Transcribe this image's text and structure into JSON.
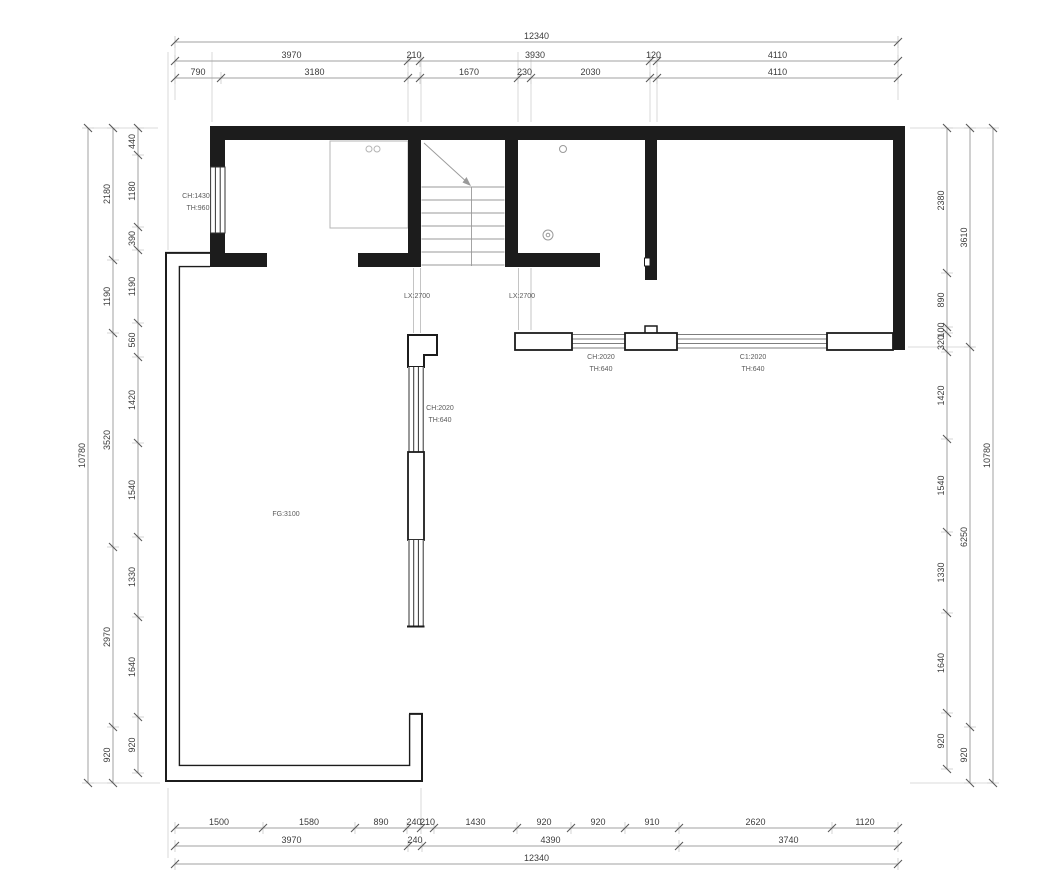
{
  "drawing": {
    "type": "floor-plan",
    "background": "#ffffff"
  },
  "colors": {
    "wall": "#1c1c1c",
    "dim_line": "#a2a2a2",
    "dim_text": "#3c3c3c",
    "tick": "#5a5a5a",
    "stub": "#c9c9c9",
    "stair": "#9a9a9a",
    "furniture": "#b5b5b5",
    "glazing": "#7d7d7d",
    "annotation": "#5a5a5a"
  },
  "dimensions": {
    "top_rows": [
      {
        "y": 42,
        "segments": [
          {
            "label": "12340",
            "a": 175,
            "b": 898
          }
        ]
      },
      {
        "y": 61,
        "segments": [
          {
            "label": "3970",
            "a": 175,
            "b": 408
          },
          {
            "label": "210",
            "a": 408,
            "b": 420
          },
          {
            "label": "3930",
            "a": 420,
            "b": 650
          },
          {
            "label": "120",
            "a": 650,
            "b": 657
          },
          {
            "label": "4110",
            "a": 657,
            "b": 898
          }
        ]
      },
      {
        "y": 78,
        "segments": [
          {
            "label": "790",
            "a": 175,
            "b": 221
          },
          {
            "label": "3180",
            "a": 221,
            "b": 408
          },
          {
            "label": "",
            "a": 408,
            "b": 420
          },
          {
            "label": "1670",
            "a": 420,
            "b": 518
          },
          {
            "label": "230",
            "a": 518,
            "b": 531
          },
          {
            "label": "2030",
            "a": 531,
            "b": 650
          },
          {
            "label": "",
            "a": 650,
            "b": 657
          },
          {
            "label": "4110",
            "a": 657,
            "b": 898
          }
        ]
      }
    ],
    "bottom_rows": [
      {
        "y": 828,
        "segments": [
          {
            "label": "1500",
            "a": 175,
            "b": 263
          },
          {
            "label": "1580",
            "a": 263,
            "b": 355
          },
          {
            "label": "890",
            "a": 355,
            "b": 407
          },
          {
            "label": "240",
            "a": 407,
            "b": 421
          },
          {
            "label": "210",
            "a": 421,
            "b": 434
          },
          {
            "label": "1430",
            "a": 434,
            "b": 517
          },
          {
            "label": "920",
            "a": 517,
            "b": 571
          },
          {
            "label": "920",
            "a": 571,
            "b": 625
          },
          {
            "label": "910",
            "a": 625,
            "b": 679
          },
          {
            "label": "2620",
            "a": 679,
            "b": 832
          },
          {
            "label": "1120",
            "a": 832,
            "b": 898
          }
        ]
      },
      {
        "y": 846,
        "segments": [
          {
            "label": "3970",
            "a": 175,
            "b": 408
          },
          {
            "label": "240",
            "a": 408,
            "b": 422
          },
          {
            "label": "4390",
            "a": 422,
            "b": 679
          },
          {
            "label": "3740",
            "a": 679,
            "b": 898
          }
        ]
      },
      {
        "y": 864,
        "segments": [
          {
            "label": "12340",
            "a": 175,
            "b": 898
          }
        ]
      }
    ],
    "left_cols": [
      {
        "x": 88,
        "segments": [
          {
            "label": "10780",
            "a": 128,
            "b": 783
          }
        ]
      },
      {
        "x": 113,
        "segments": [
          {
            "label": "2180",
            "a": 128,
            "b": 260
          },
          {
            "label": "1190",
            "a": 260,
            "b": 333
          },
          {
            "label": "3520",
            "a": 333,
            "b": 547
          },
          {
            "label": "2970",
            "a": 547,
            "b": 727
          },
          {
            "label": "920",
            "a": 727,
            "b": 783
          }
        ]
      },
      {
        "x": 138,
        "segments": [
          {
            "label": "440",
            "a": 128,
            "b": 155
          },
          {
            "label": "1180",
            "a": 155,
            "b": 227
          },
          {
            "label": "390",
            "a": 227,
            "b": 250
          },
          {
            "label": "1190",
            "a": 250,
            "b": 323
          },
          {
            "label": "560",
            "a": 323,
            "b": 357
          },
          {
            "label": "1420",
            "a": 357,
            "b": 443
          },
          {
            "label": "1540",
            "a": 443,
            "b": 537
          },
          {
            "label": "1330",
            "a": 537,
            "b": 617
          },
          {
            "label": "1640",
            "a": 617,
            "b": 717
          },
          {
            "label": "920",
            "a": 717,
            "b": 773
          }
        ]
      }
    ],
    "right_cols": [
      {
        "x": 947,
        "segments": [
          {
            "label": "2380",
            "a": 128,
            "b": 273
          },
          {
            "label": "890",
            "a": 273,
            "b": 327
          },
          {
            "label": "100",
            "a": 327,
            "b": 333
          },
          {
            "label": "320",
            "a": 333,
            "b": 352
          },
          {
            "label": "1420",
            "a": 352,
            "b": 439
          },
          {
            "label": "1540",
            "a": 439,
            "b": 532
          },
          {
            "label": "1330",
            "a": 532,
            "b": 613
          },
          {
            "label": "1640",
            "a": 613,
            "b": 713
          },
          {
            "label": "920",
            "a": 713,
            "b": 769
          }
        ]
      },
      {
        "x": 970,
        "segments": [
          {
            "label": "3610",
            "a": 128,
            "b": 347
          },
          {
            "label": "6250",
            "a": 347,
            "b": 727
          },
          {
            "label": "920",
            "a": 727,
            "b": 783
          }
        ]
      },
      {
        "x": 993,
        "segments": [
          {
            "label": "10780",
            "a": 128,
            "b": 783
          }
        ]
      }
    ]
  },
  "annotations": [
    {
      "id": "west-window-label-1",
      "text": "CH:1430",
      "x": 196,
      "y": 198
    },
    {
      "id": "west-window-label-2",
      "text": "TH:960",
      "x": 198,
      "y": 210
    },
    {
      "id": "passage-label-1",
      "text": "LX:2700",
      "x": 417,
      "y": 298
    },
    {
      "id": "passage-label-2",
      "text": "LX:2700",
      "x": 522,
      "y": 298
    },
    {
      "id": "south-window-label-1a",
      "text": "CH:2020",
      "x": 601,
      "y": 359
    },
    {
      "id": "south-window-label-1b",
      "text": "TH:640",
      "x": 601,
      "y": 371
    },
    {
      "id": "south-window-label-2a",
      "text": "C1:2020",
      "x": 753,
      "y": 359
    },
    {
      "id": "south-window-label-2b",
      "text": "TH:640",
      "x": 753,
      "y": 371
    },
    {
      "id": "west-column-window-label-a",
      "text": "CH:2020",
      "x": 440,
      "y": 410
    },
    {
      "id": "west-column-window-label-b",
      "text": "TH:640",
      "x": 440,
      "y": 422
    },
    {
      "id": "floor-height-label",
      "text": "FG:3100",
      "x": 286,
      "y": 516
    }
  ]
}
